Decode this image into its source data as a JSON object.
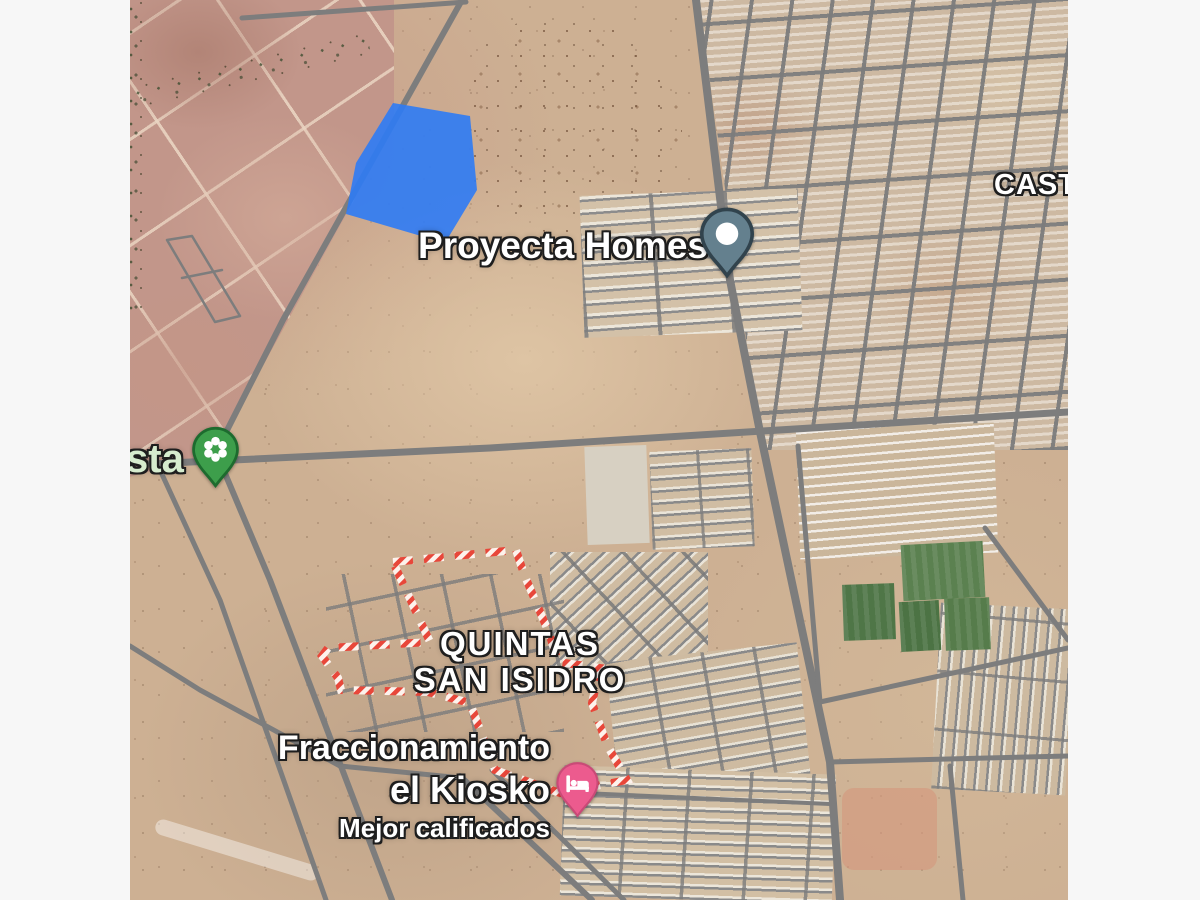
{
  "window": {
    "width": 1200,
    "height": 900,
    "margin_color": "#f7f7f7",
    "view": "satellite-map"
  },
  "map": {
    "labels": {
      "proyecta_homes": "Proyecta Homes",
      "cast_partial": "CAST",
      "sta_partial": "sta",
      "quintas_line1": "QUINTAS",
      "quintas_line2": "SAN ISIDRO",
      "fraccionamiento_line1": "Fraccionamiento",
      "fraccionamiento_line2": "el Kiosko",
      "fraccionamiento_subtitle": "Mejor calificados"
    },
    "markers": [
      {
        "id": "proyecta-homes-pin",
        "kind": "default-poi",
        "color": "#64808e"
      },
      {
        "id": "park-flower-pin",
        "kind": "park",
        "color": "#3d9e4b"
      },
      {
        "id": "hotel-bed-pin",
        "kind": "hotel",
        "color": "#ec5b8e"
      }
    ],
    "colors": {
      "parcel_blue": "#2e7bf5",
      "boundary_red": "#e8473a",
      "boundary_white": "#fdf2ec",
      "road_gray": "#7d7d7d",
      "desert_tan": "#cdb093",
      "field_pink": "#c2968a",
      "sports_green": "#567a4b",
      "pin_gray": "#64808e",
      "pin_gray_stroke": "#31434d",
      "pin_green": "#3d9e4b",
      "pin_green_stroke": "#1d6b2e",
      "pin_pink": "#ec5b8e",
      "pin_pink_stroke": "#c94a77"
    }
  }
}
